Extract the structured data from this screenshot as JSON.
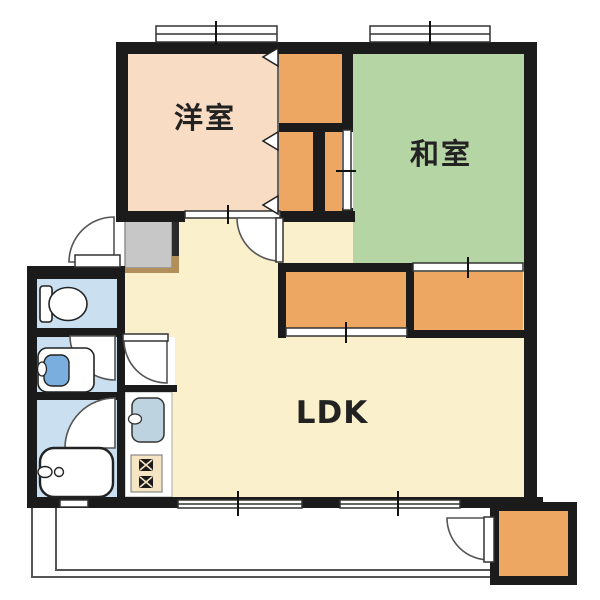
{
  "floorplan": {
    "title": "2LDK apartment floor plan",
    "rooms": [
      {
        "id": "western-room",
        "label": "洋室",
        "color": "#f9dcc4"
      },
      {
        "id": "japanese-room",
        "label": "和室",
        "color": "#b5d5a5"
      },
      {
        "id": "ldk",
        "label": "LDK",
        "color": "#fbf0cc"
      }
    ],
    "palette": {
      "wall": "#1b1b1b",
      "closet_orange": "#eea763",
      "wet_area_blue": "#cadff0",
      "basin_blue": "#79aede",
      "sink_blue": "#bdd3e0",
      "stove_beige": "#f6e5c2",
      "entrance_gray": "#c7c7c7",
      "step_tan": "#b18f5a",
      "line_gray": "#555555"
    },
    "fixtures": [
      "toilet-icon",
      "washbasin-icon",
      "bathtub-icon",
      "kitchen-sink-icon",
      "stove-icon",
      "storage-box",
      "balcony-fence"
    ]
  }
}
